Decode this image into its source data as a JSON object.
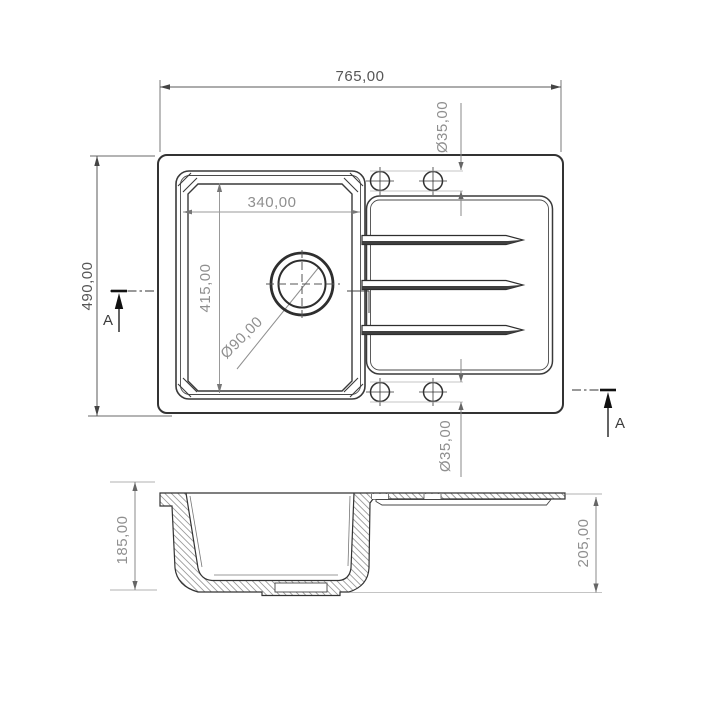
{
  "drawing": {
    "subject": "kitchen sink with drainboard - technical drawing, top view and section A-A",
    "top_view": {
      "dim_overall_width": "765,00",
      "dim_overall_depth": "490,00",
      "dim_bowl_width": "340,00",
      "dim_bowl_depth": "415,00",
      "dim_drain_diameter": "Ø90,00",
      "dim_tap_hole_top": "Ø35,00",
      "dim_tap_hole_bottom": "Ø35,00",
      "section_label_left": "A",
      "section_label_right": "A"
    },
    "section_view": {
      "dim_bowl_inner_depth": "185,00",
      "dim_overall_height": "205,00"
    },
    "colors": {
      "line": "#333333",
      "dim_dark": "#565656",
      "dim_light": "#8f8f8f",
      "hatch": "#9a9a9a",
      "background": "#ffffff"
    }
  }
}
